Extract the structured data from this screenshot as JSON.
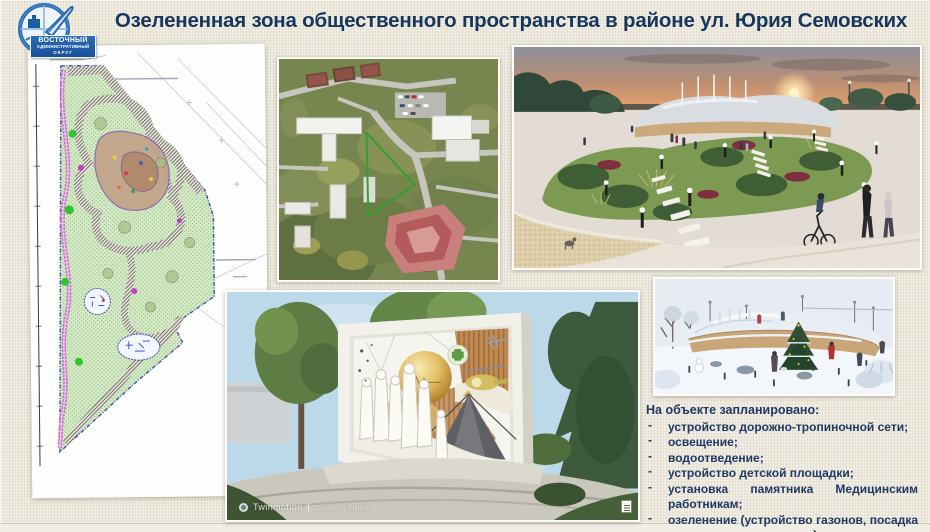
{
  "slide": {
    "title": "Озелененная зона общественного пространства в районе ул. Юрия Семовских"
  },
  "logo": {
    "district_line1": "ВОСТОЧНЫЙ",
    "district_line2": "АДМИНИСТРАТИВНЫЙ",
    "district_line3": "ОКРУГ"
  },
  "planned": {
    "header": "На объекте запланировано:",
    "items": [
      "устройство дорожно-тропиночной сети;",
      "освещение;",
      "водоотведение;",
      "устройство детской площадки;",
      "установка памятника Медицинским работникам;",
      "озеленение (устройство газонов, посадка деревьев и кустарников)"
    ]
  },
  "monument_render": {
    "watermark_brand": "Twinmotion",
    "watermark_edition": "Community Edition"
  },
  "colors": {
    "background": "#ece8db",
    "title_text": "#17365d",
    "list_text": "#1f3864",
    "logo_blue": "#1b4f9c",
    "site_outline_green": "#2fa12f",
    "plan_boundary_blue": "#4553a8",
    "plan_path_magenta": "#cf6ad0"
  }
}
